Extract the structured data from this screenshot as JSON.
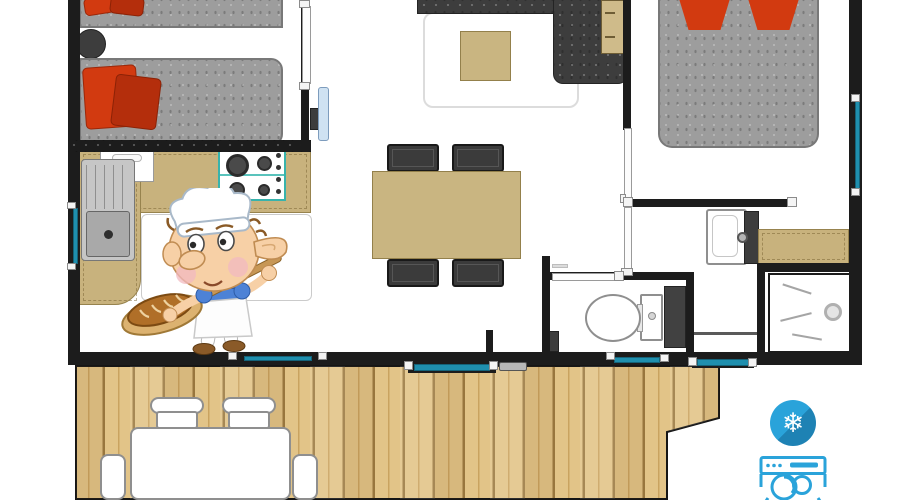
{
  "meta": {
    "type": "floor-plan",
    "subject": "mobile-home floor plan with wooden terrace",
    "canvas_width": 900,
    "canvas_height": 500
  },
  "palette": {
    "wall": "#1c1c1c",
    "floor": "#ffffff",
    "bed_gray": "#9d9d9d",
    "sofa_gray": "#3d3d3d",
    "pillow_red": "#d23a10",
    "pillow_red_deep": "#b42e0c",
    "tan": "#c8b27d",
    "tan_mid": "#c9b581",
    "wood": "#e2c488",
    "wood_dark": "#9c7a42",
    "teal": "#1f8fae",
    "stove_teal": "#38b3ac",
    "icon_blue": "#2aa3da",
    "icon_blue_dark": "#1e82b4"
  },
  "rooms": [
    {
      "id": "bedroom-twin",
      "contents": [
        "single-bed",
        "single-bed",
        "round-nightstand",
        "red-pillows"
      ]
    },
    {
      "id": "kitchen",
      "contents": [
        "l-shaped-counter",
        "sink-unit",
        "gas-hob",
        "wall-cabinet",
        "floor-mat"
      ]
    },
    {
      "id": "living-room",
      "contents": [
        "corner-sofa",
        "rug",
        "coffee-table",
        "wall-tv",
        "side-desk"
      ]
    },
    {
      "id": "dining-area",
      "contents": [
        "table",
        "four-chairs"
      ]
    },
    {
      "id": "bedroom-double",
      "contents": [
        "double-bed",
        "red-pillows"
      ]
    },
    {
      "id": "washroom",
      "contents": [
        "washbasin",
        "vanity-panel",
        "counter"
      ]
    },
    {
      "id": "wc",
      "contents": [
        "toilet",
        "bin"
      ]
    },
    {
      "id": "shower-room",
      "contents": [
        "shower-tray",
        "drain"
      ]
    },
    {
      "id": "terrace",
      "contents": [
        "wood-deck",
        "outdoor-table",
        "outdoor-chairs"
      ]
    }
  ],
  "icons": [
    {
      "name": "air-conditioning-icon",
      "glyph": "❄"
    },
    {
      "name": "dishwasher-icon"
    }
  ],
  "mascot": {
    "name": "baker-elf",
    "props": [
      "chef-hat",
      "baker-peel",
      "bread-loaf"
    ]
  }
}
